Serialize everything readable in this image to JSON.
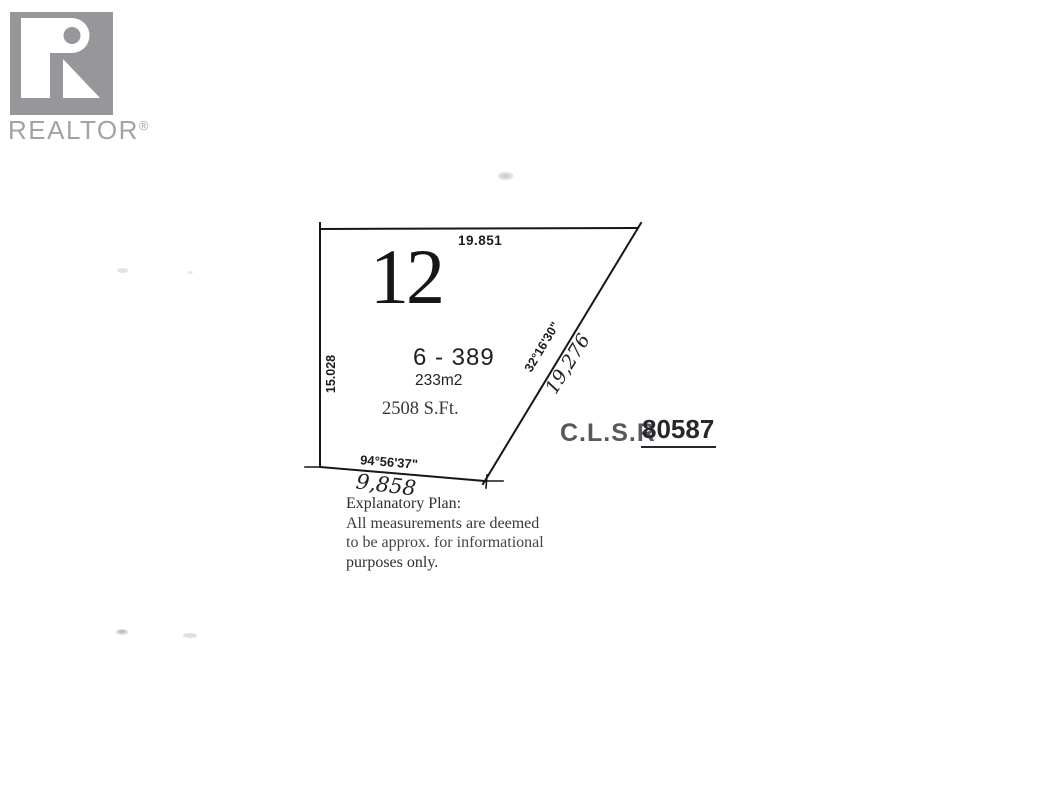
{
  "colors": {
    "ink": "#1a1a1a",
    "logo_gray": "#97979b",
    "wordmark_gray": "#a3a3a7",
    "muted_gray": "#58585c"
  },
  "logo": {
    "brand": "REALTOR",
    "registered": "®"
  },
  "plan": {
    "lot_number": "12",
    "plan_number": "6 - 389",
    "area_metric": "233m2",
    "area_imperial": "2508 S.Ft.",
    "clsr_label": "C.L.S.R",
    "clsr_number": "80587",
    "dimensions": {
      "top": "19.851",
      "left": "15.028",
      "diagonal": "19,276",
      "bottom": "9,858"
    },
    "bearings": {
      "diagonal": "32°16'30\"",
      "bottom": "94°56'37\""
    }
  },
  "disclaimer": {
    "lines": [
      "Explanatory Plan:",
      "All measurements are deemed",
      "to be approx. for informational",
      "purposes only."
    ]
  }
}
